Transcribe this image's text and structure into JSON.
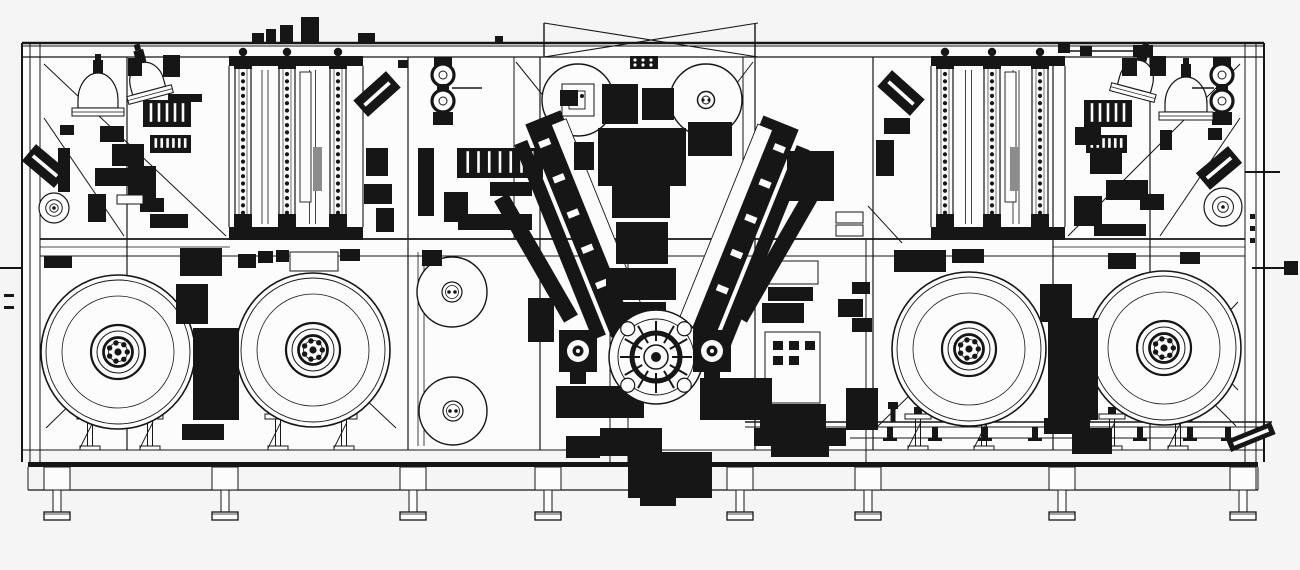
{
  "drawing": {
    "type": "cad-machine-side-elevation",
    "description": "monochrome engineering line drawing of a long automated production machine with unwind reels, process towers, hoppers and a central V-shaped winding turret",
    "bg": "#f5f5f6",
    "paper": "#fcfcfc",
    "ink": "#161616",
    "gray": "#8c8c8c",
    "frame": {
      "x1": 22,
      "y1": 43,
      "x2": 1264,
      "y2": 450,
      "rail_ys": [
        43,
        46,
        57
      ],
      "mid_rail_ys": [
        239,
        247,
        256
      ],
      "left_cluster": [
        22,
        30,
        40
      ],
      "right_cluster": [
        1245,
        1256,
        1264
      ],
      "posts_full": [
        127,
        408,
        540,
        755,
        873,
        1053,
        1150
      ],
      "posts_upper": [
        514,
        743
      ],
      "posts_lower": [
        610,
        628,
        866
      ],
      "base": {
        "light_y": 450,
        "beam_y1": 462,
        "beam_y2": 467,
        "chord_y": 490,
        "edge_x1": 28,
        "edge_x2": 1258
      },
      "braces": [
        [
          44,
          64,
          226,
          236
        ],
        [
          44,
          118,
          124,
          236
        ],
        [
          1240,
          64,
          1068,
          236
        ],
        [
          1240,
          118,
          1160,
          236
        ],
        [
          516,
          62,
          574,
          134
        ],
        [
          753,
          62,
          698,
          134
        ],
        [
          868,
          206,
          902,
          243
        ],
        [
          46,
          428,
          120,
          356
        ],
        [
          396,
          428,
          322,
          358
        ],
        [
          878,
          426,
          948,
          358
        ],
        [
          1236,
          426,
          1166,
          356
        ],
        [
          1154,
          302,
          1238,
          390
        ],
        [
          1238,
          302,
          1154,
          390
        ]
      ]
    },
    "top_brace": {
      "x1": 544,
      "x2": 755,
      "y_top": 23,
      "y_bot": 57
    },
    "feet": {
      "centers": [
        57,
        225,
        413,
        548,
        740,
        868,
        1062,
        1243
      ],
      "block_w": 26,
      "block_y": 467,
      "block_h": 23,
      "stem_w": 8,
      "stem_y": 490,
      "stem_h": 22,
      "pad_w": 26,
      "pad_y": 512,
      "pad_h": 8
    },
    "reels": [
      {
        "cx": 118,
        "cy": 352,
        "r": 77
      },
      {
        "cx": 313,
        "cy": 350,
        "r": 77
      },
      {
        "cx": 969,
        "cy": 349,
        "r": 77
      },
      {
        "cx": 1164,
        "cy": 348,
        "r": 77
      }
    ],
    "reel_hub": {
      "rim": 72,
      "face": 56,
      "rings": [
        27,
        21,
        14.5
      ],
      "white_r": 9.5,
      "bolts": 7,
      "bolt_ring": 9.3,
      "bolt_r": 2.7,
      "center_r": 3.6
    },
    "mid_reels": [
      {
        "cx": 452,
        "cy": 292,
        "r": 35
      },
      {
        "cx": 453,
        "cy": 411,
        "r": 34
      }
    ],
    "belt_lines": [
      [
        418,
        252,
        418,
        446
      ],
      [
        424,
        252,
        424,
        446
      ]
    ],
    "top_rollers": [
      {
        "cx": 578,
        "cy": 100,
        "r": 36,
        "style": "bracket"
      },
      {
        "cx": 706,
        "cy": 100,
        "r": 36,
        "style": "hub"
      }
    ],
    "roller_stacks": [
      {
        "cx": 443
      },
      {
        "cx": 1222
      }
    ],
    "spirals": [
      {
        "cx": 54,
        "cy": 208,
        "r": 15
      },
      {
        "cx": 1223,
        "cy": 207,
        "r": 19
      }
    ],
    "turret": {
      "cx": 656,
      "cy": 357,
      "r": 47,
      "spokes": 12
    },
    "press_units": [
      {
        "cx": 578,
        "cy": 351
      },
      {
        "cx": 712,
        "cy": 351
      }
    ],
    "v_arms": {
      "left": {
        "angle": -22,
        "px": 586,
        "py": 224,
        "main": [
          567,
          109,
          38,
          230
        ],
        "inner": [
          549,
          124,
          14,
          210
        ],
        "stripe": [
          591,
          119,
          16,
          220
        ],
        "dash_x": 572
      },
      "right": {
        "angle": 22,
        "px": 725,
        "py": 224,
        "main": [
          720,
          109,
          38,
          230
        ],
        "inner": [
          762,
          124,
          14,
          210
        ],
        "stripe": [
          718,
          119,
          16,
          220
        ],
        "dash_x": 741
      },
      "outer_left": {
        "angle": -30,
        "px": 536,
        "py": 258,
        "rect": [
          528,
          188,
          16,
          140
        ]
      },
      "outer_right": {
        "angle": 30,
        "px": 775,
        "py": 258,
        "rect": [
          767,
          188,
          16,
          140
        ]
      }
    },
    "center_stack": [
      [
        602,
        84,
        36,
        40
      ],
      [
        642,
        88,
        32,
        32
      ],
      [
        560,
        90,
        18,
        16
      ],
      [
        688,
        122,
        44,
        34
      ],
      [
        574,
        142,
        20,
        28
      ],
      [
        598,
        128,
        88,
        58
      ],
      [
        612,
        186,
        58,
        32
      ],
      [
        616,
        222,
        52,
        42
      ],
      [
        606,
        268,
        70,
        32
      ],
      [
        620,
        302,
        46,
        26
      ]
    ],
    "connector": {
      "x": 630,
      "y": 56,
      "w": 28,
      "h": 13,
      "dots": 6
    },
    "towers": [
      {
        "x1": 229,
        "x2": 363,
        "cols": [
          243,
          287,
          338
        ],
        "white_col": [
          300,
          72,
          11,
          130
        ]
      },
      {
        "x1": 931,
        "x2": 1065,
        "cols": [
          945,
          992,
          1040
        ],
        "white_col": [
          1005,
          72,
          11,
          130
        ]
      }
    ],
    "gray_bars": [
      [
        313,
        147,
        9,
        44
      ],
      [
        1010,
        147,
        9,
        44
      ]
    ],
    "domes": [
      {
        "cx": 98,
        "cy": 100,
        "rx": 20,
        "ry": 27,
        "rot": 0
      },
      {
        "cx": 147,
        "cy": 83,
        "rx": 17,
        "ry": 21,
        "rot": -15
      },
      {
        "cx": 1186,
        "cy": 104,
        "rx": 21,
        "ry": 27,
        "rot": 0
      },
      {
        "cx": 1136,
        "cy": 81,
        "rx": 17,
        "ry": 21,
        "rot": 15
      }
    ],
    "combs": [
      {
        "x": 143,
        "y": 100,
        "w": 48,
        "h": 27,
        "teeth": 6
      },
      {
        "x": 150,
        "y": 135,
        "w": 41,
        "h": 18,
        "teeth": 7
      },
      {
        "x": 1084,
        "y": 100,
        "w": 48,
        "h": 27,
        "teeth": 6
      },
      {
        "x": 1086,
        "y": 135,
        "w": 41,
        "h": 18,
        "teeth": 7
      },
      {
        "x": 457,
        "y": 148,
        "w": 86,
        "h": 30,
        "teeth": 8
      }
    ],
    "angled_units": [
      {
        "cx": 45,
        "cy": 166,
        "w": 42,
        "h": 22,
        "rot": 40
      },
      {
        "cx": 377,
        "cy": 94,
        "w": 44,
        "h": 22,
        "rot": -42
      },
      {
        "cx": 901,
        "cy": 93,
        "w": 44,
        "h": 22,
        "rot": 42
      },
      {
        "cx": 1219,
        "cy": 168,
        "w": 42,
        "h": 22,
        "rot": -40
      },
      {
        "cx": 1251,
        "cy": 437,
        "w": 48,
        "h": 13,
        "rot": -22
      }
    ],
    "stands": {
      "xs": [
        90,
        150,
        278,
        344,
        918,
        984,
        1112,
        1178
      ],
      "y": 414
    },
    "conveyor": {
      "x1": 745,
      "x2": 1272,
      "y": 422,
      "drops": [
        890,
        935,
        985,
        1035,
        1140,
        1190,
        1228
      ],
      "knobs": [
        893,
        988,
        1088,
        1190
      ],
      "motor": [
        1072,
        428,
        40,
        26
      ]
    },
    "blocks": [
      [
        163,
        55,
        17,
        22
      ],
      [
        128,
        58,
        14,
        18
      ],
      [
        100,
        126,
        24,
        16
      ],
      [
        112,
        144,
        32,
        22
      ],
      [
        95,
        168,
        42,
        18
      ],
      [
        128,
        166,
        28,
        32
      ],
      [
        88,
        194,
        18,
        28
      ],
      [
        140,
        198,
        24,
        14
      ],
      [
        117,
        195,
        26,
        9,
        "w"
      ],
      [
        58,
        148,
        12,
        44
      ],
      [
        150,
        214,
        38,
        14
      ],
      [
        168,
        94,
        34,
        8
      ],
      [
        44,
        256,
        28,
        12
      ],
      [
        60,
        125,
        14,
        10
      ],
      [
        366,
        148,
        22,
        28
      ],
      [
        364,
        184,
        28,
        20
      ],
      [
        376,
        208,
        18,
        24
      ],
      [
        398,
        60,
        10,
        8
      ],
      [
        418,
        148,
        16,
        68
      ],
      [
        444,
        192,
        24,
        30
      ],
      [
        490,
        182,
        42,
        14
      ],
      [
        458,
        214,
        74,
        16
      ],
      [
        422,
        250,
        20,
        16
      ],
      [
        787,
        151,
        47,
        50
      ],
      [
        836,
        212,
        27,
        11,
        "w"
      ],
      [
        836,
        225,
        27,
        11,
        "w"
      ],
      [
        764,
        261,
        54,
        23,
        "w"
      ],
      [
        768,
        287,
        45,
        14
      ],
      [
        762,
        303,
        42,
        20
      ],
      [
        765,
        332,
        55,
        71,
        "w"
      ],
      [
        773,
        341,
        10,
        9
      ],
      [
        789,
        341,
        10,
        9
      ],
      [
        805,
        341,
        10,
        9
      ],
      [
        773,
        356,
        10,
        9
      ],
      [
        789,
        356,
        10,
        9
      ],
      [
        760,
        404,
        66,
        28
      ],
      [
        771,
        435,
        58,
        22
      ],
      [
        838,
        299,
        25,
        18
      ],
      [
        852,
        318,
        20,
        14
      ],
      [
        846,
        388,
        32,
        42
      ],
      [
        852,
        282,
        18,
        12
      ],
      [
        884,
        118,
        26,
        16
      ],
      [
        876,
        140,
        18,
        36
      ],
      [
        1122,
        58,
        15,
        18
      ],
      [
        1150,
        56,
        16,
        20
      ],
      [
        1075,
        127,
        26,
        18
      ],
      [
        1090,
        150,
        32,
        24
      ],
      [
        1106,
        180,
        42,
        20
      ],
      [
        1074,
        196,
        28,
        30
      ],
      [
        1140,
        194,
        24,
        16
      ],
      [
        1094,
        224,
        52,
        12
      ],
      [
        1160,
        130,
        12,
        20
      ],
      [
        1208,
        128,
        14,
        12
      ],
      [
        176,
        284,
        32,
        40
      ],
      [
        193,
        328,
        46,
        92
      ],
      [
        182,
        424,
        42,
        16
      ],
      [
        238,
        254,
        18,
        14
      ],
      [
        258,
        251,
        15,
        12
      ],
      [
        276,
        250,
        13,
        12
      ],
      [
        290,
        252,
        48,
        19,
        "w"
      ],
      [
        180,
        248,
        42,
        28
      ],
      [
        340,
        249,
        20,
        12
      ],
      [
        528,
        298,
        26,
        44
      ],
      [
        566,
        436,
        34,
        22
      ],
      [
        600,
        428,
        62,
        28
      ],
      [
        628,
        452,
        84,
        46
      ],
      [
        640,
        498,
        36,
        8
      ],
      [
        556,
        386,
        88,
        32
      ],
      [
        700,
        378,
        72,
        42
      ],
      [
        754,
        428,
        92,
        18
      ],
      [
        1040,
        284,
        32,
        38
      ],
      [
        1048,
        318,
        50,
        102
      ],
      [
        1044,
        418,
        46,
        16
      ],
      [
        894,
        250,
        52,
        22
      ],
      [
        952,
        249,
        32,
        14
      ],
      [
        1108,
        253,
        28,
        16
      ],
      [
        1180,
        252,
        20,
        12
      ],
      [
        1250,
        214,
        5,
        5
      ],
      [
        1250,
        226,
        5,
        5
      ],
      [
        1250,
        238,
        5,
        5
      ],
      [
        4,
        294,
        10,
        3
      ],
      [
        4,
        306,
        10,
        3
      ]
    ],
    "top_fixtures": [
      [
        252,
        33,
        12,
        10
      ],
      [
        266,
        29,
        10,
        14
      ],
      [
        280,
        25,
        13,
        18
      ],
      [
        301,
        17,
        18,
        26
      ],
      [
        358,
        33,
        17,
        10
      ],
      [
        495,
        36,
        8,
        7
      ],
      [
        1058,
        43,
        12,
        10
      ],
      [
        1080,
        46,
        12,
        10
      ],
      [
        1133,
        45,
        20,
        12
      ]
    ],
    "aux_lines": [
      [
        1068,
        51,
        1134,
        51
      ],
      [
        452,
        88,
        482,
        88
      ],
      [
        1192,
        88,
        1214,
        88
      ]
    ],
    "pins": [
      [
        0,
        268,
        22,
        268
      ],
      [
        1245,
        172,
        1280,
        172
      ],
      [
        1252,
        268,
        1286,
        268
      ]
    ],
    "pin_tip": [
      1284,
      261,
      14,
      14
    ]
  }
}
